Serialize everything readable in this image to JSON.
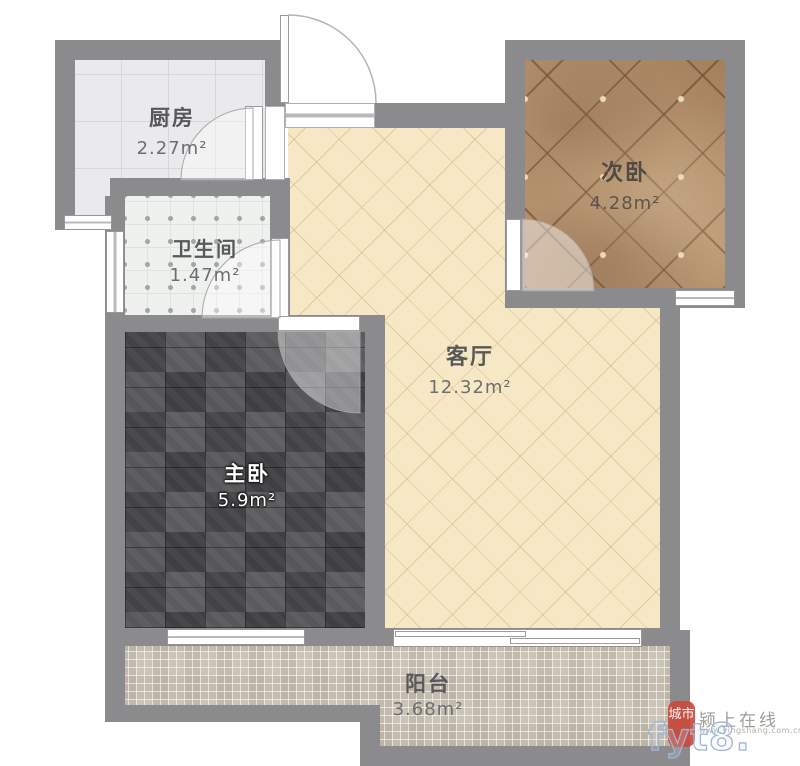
{
  "plan": {
    "title": "一室一厅户型平面图",
    "rooms": [
      {
        "id": "kitchen",
        "name": "厨房",
        "area": "2.27m²"
      },
      {
        "id": "bathroom",
        "name": "卫生间",
        "area": "1.47m²"
      },
      {
        "id": "bedroom2",
        "name": "次卧",
        "area": "4.28m²"
      },
      {
        "id": "living",
        "name": "客厅",
        "area": "12.32m²"
      },
      {
        "id": "bedroom1",
        "name": "主卧",
        "area": "5.9m²"
      },
      {
        "id": "balcony",
        "name": "阳台",
        "area": "3.68m²"
      }
    ]
  },
  "watermark": {
    "seal_text": "城市",
    "site_name": "颍上在线",
    "site_url_small": "www.yingshang.com.cn",
    "site_url_large": "fyt8. cn"
  },
  "colors": {
    "wall": "#8b8b8e",
    "kitchen_floor": "#eaeaec",
    "bathroom_floor": "#eef1ee",
    "living_floor": "#f6e8c5",
    "bedroom2_floor": "#b18c68",
    "bedroom1_floor": "#4a4a4c",
    "balcony_floor": "#cbc3b5",
    "seal_red": "#cd4a3c",
    "watermark_outline": "#9fb6d2"
  }
}
